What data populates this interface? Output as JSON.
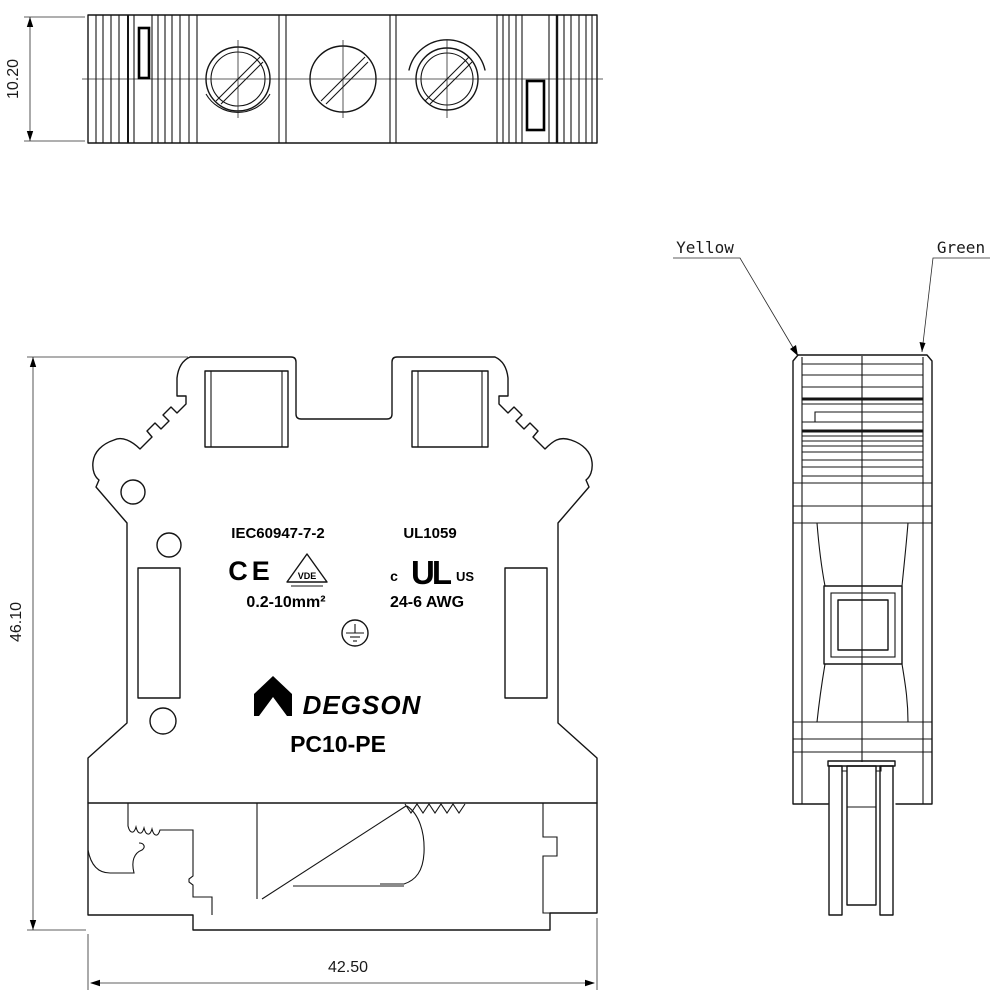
{
  "markings": {
    "standard_iec": "IEC60947-7-2",
    "standard_ul": "UL1059",
    "ce_mark": "CE",
    "vde_mark": "VDE",
    "wire_range_mm": "0.2-10mm²",
    "cul_prefix": "c",
    "cul_monogram": "UL",
    "cul_suffix": "US",
    "wire_range_awg": "24-6 AWG",
    "brand": "DEGSON",
    "model": "PC10-PE"
  },
  "dimensions": {
    "top_view_height": "10.20",
    "front_view_height": "46.10",
    "front_view_width": "42.50"
  },
  "callouts": {
    "left": "Yellow",
    "right": "Green"
  },
  "colors": {
    "line": "#141414",
    "background": "#ffffff"
  }
}
